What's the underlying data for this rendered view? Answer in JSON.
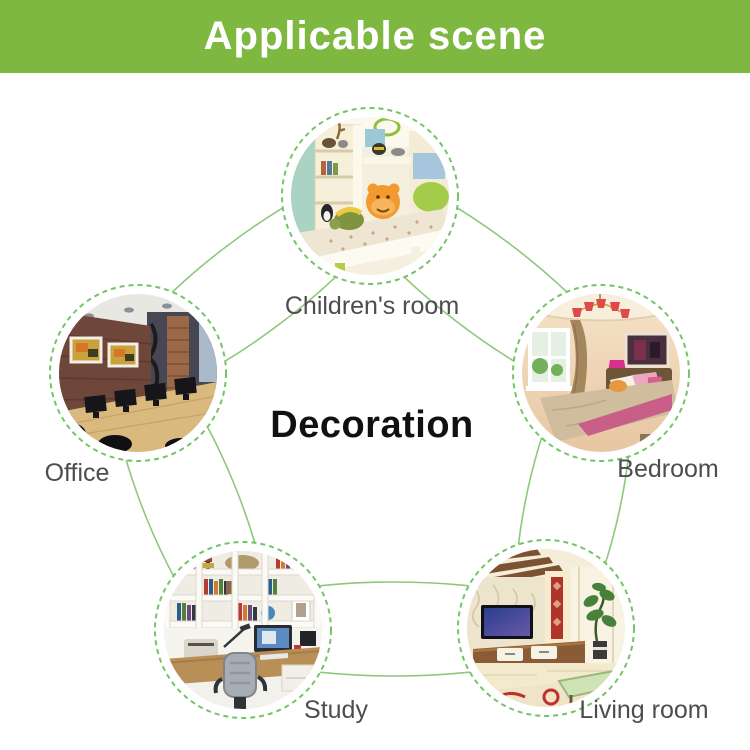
{
  "header": {
    "title": "Applicable scene"
  },
  "center_label": "Decoration",
  "scenes": [
    {
      "id": "children-room",
      "label": "Children's room"
    },
    {
      "id": "bedroom",
      "label": "Bedroom"
    },
    {
      "id": "living-room",
      "label": "Living room"
    },
    {
      "id": "study",
      "label": "Study"
    },
    {
      "id": "office",
      "label": "Office"
    }
  ],
  "colors": {
    "header_bg": "#7eb840",
    "header_text": "#ffffff",
    "orbit_line": "#8dc87d",
    "dashed_ring": "#72c566",
    "label_text": "#4d4d4d",
    "center_text": "#111111"
  }
}
